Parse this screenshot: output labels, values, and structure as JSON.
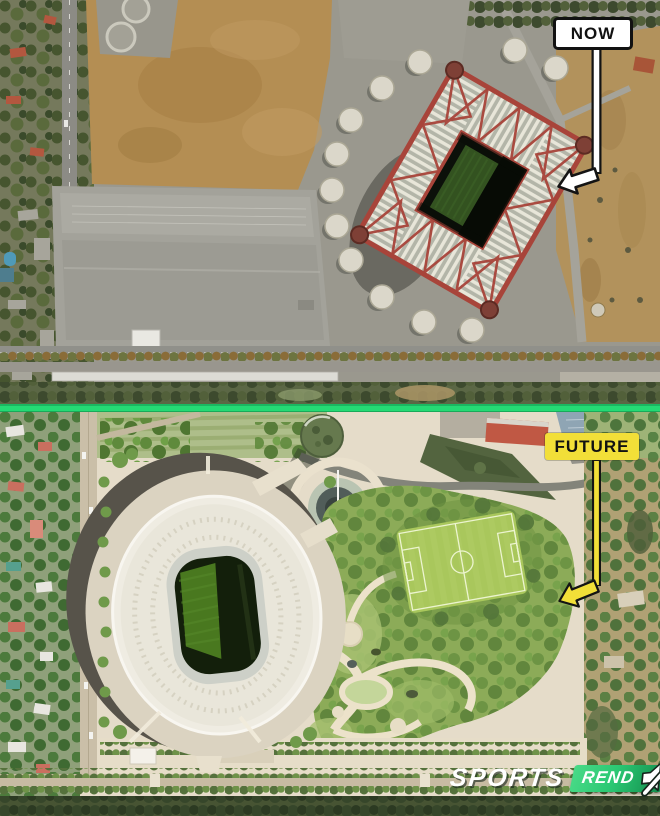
{
  "colors": {
    "divider_green": "#25da74",
    "label_yellow": "#f2df38",
    "label_white": "#ffffff",
    "label_text": "#121212",
    "watermark_green": "#2bc873",
    "watermark_text": "#ffffff"
  },
  "top_panel": {
    "callout_label": "NOW"
  },
  "bottom_panel": {
    "callout_label": "FUTURE"
  },
  "watermark": {
    "brand": "SPORTS",
    "brand_suffix": "REND"
  },
  "icons": {
    "now_pointer": "arrow-down-left-icon",
    "future_pointer": "arrow-down-left-icon",
    "watermark_audio": "muted-speaker-icon"
  }
}
